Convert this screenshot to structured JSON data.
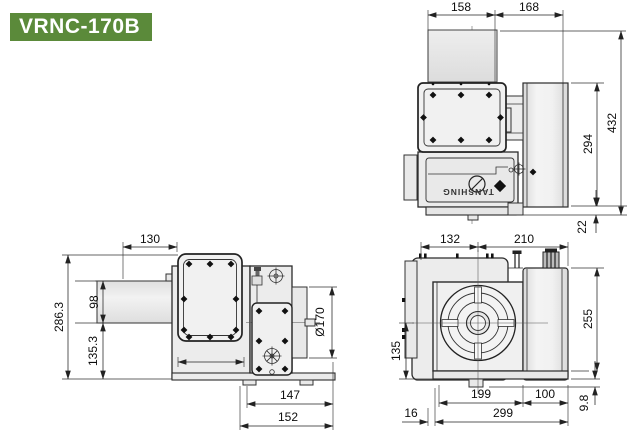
{
  "title": "VRNC-170B",
  "brand_label": "TANSHING",
  "colors": {
    "badge_green": "#5b8a3a",
    "badge_text": "#ffffff",
    "drawing_line": "#2b2b2b",
    "dimension_text": "#111111",
    "body_fill": "#ececec"
  },
  "views": {
    "plan": {
      "dims": {
        "plate_width": "158",
        "housing_width": "168",
        "overall_length": "432",
        "body_length": "294",
        "foot_depth": "22"
      }
    },
    "side": {
      "dims": {
        "motor_length": "130",
        "overall_height": "286.3",
        "motor_height": "98",
        "center_height": "135.3",
        "faceplate_diameter": "Ø170",
        "gearbox_width": "147",
        "base_width": "152"
      }
    },
    "front": {
      "dims": {
        "center_to_left": "132",
        "center_to_right": "210",
        "body_height": "255",
        "center_height": "135",
        "body_width": "199",
        "motor_width": "100",
        "base_offset": "16",
        "overall_width": "299",
        "foot_height": "9.8"
      }
    }
  }
}
